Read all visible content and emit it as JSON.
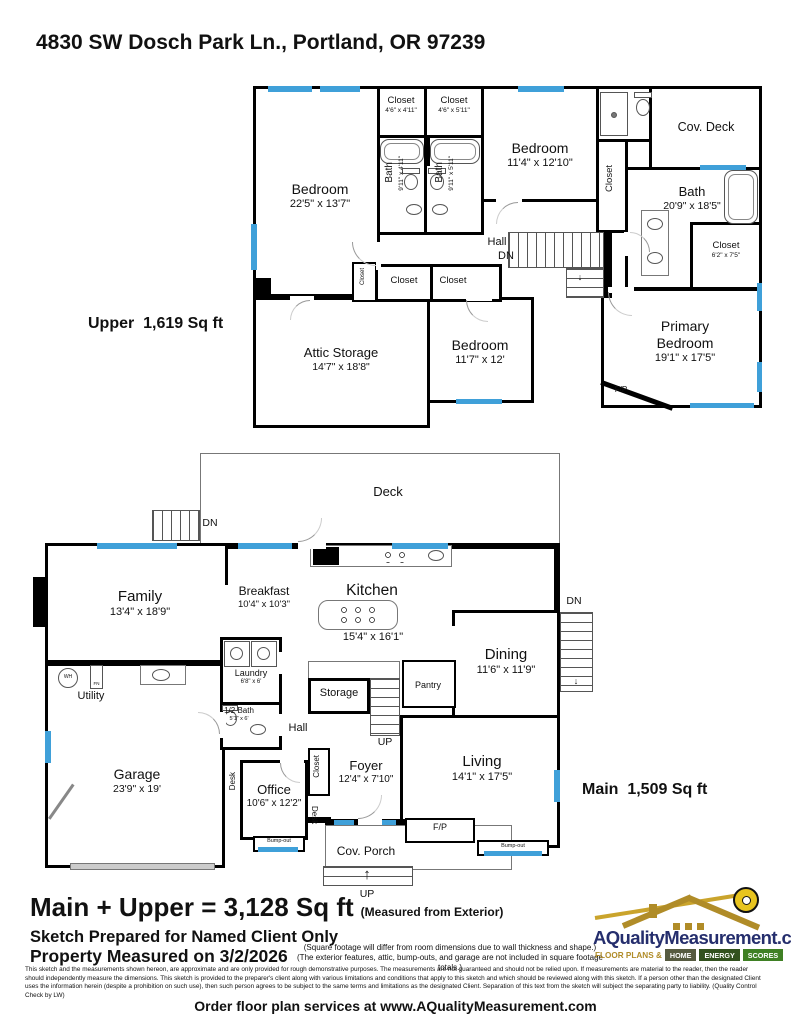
{
  "title": "4830 SW Dosch Park Ln., Portland, OR 97239",
  "icons": {
    "up_arrow": "↑",
    "down_arrow": "↓"
  },
  "upper": {
    "area_label": "Upper  1,619 Sq ft",
    "rooms": {
      "bedroom1": {
        "name": "Bedroom",
        "dims": "22'5\" x 13'7\""
      },
      "closet1": {
        "name": "Closet",
        "dims": "4'6\" x 4'11\""
      },
      "closet2": {
        "name": "Closet",
        "dims": "4'6\" x 5'11\""
      },
      "bath1": {
        "name": "Bath",
        "dims": "9'11\" x 4'11\""
      },
      "bath2": {
        "name": "Bath",
        "dims": "9'11\" x 5'11\""
      },
      "bedroom2": {
        "name": "Bedroom",
        "dims": "11'4\" x 12'10\""
      },
      "cov_deck": {
        "name": "Cov. Deck"
      },
      "closet3": {
        "name": "Closet"
      },
      "bath3": {
        "name": "Bath",
        "dims": "20'9\" x 18'5\""
      },
      "closet4": {
        "name": "Closet",
        "dims": "6'2\" x 7'5\""
      },
      "hall": {
        "name": "Hall"
      },
      "dn": "DN",
      "closet5": {
        "name": "Closet"
      },
      "closet6": {
        "name": "Closet"
      },
      "closet7": {
        "name": "Closet"
      },
      "attic": {
        "name": "Attic Storage",
        "dims": "14'7\" x 18'8\""
      },
      "bedroom3": {
        "name": "Bedroom",
        "dims": "11'7\" x 12'"
      },
      "primary": {
        "name": "Primary Bedroom",
        "dims": "19'1\" x 17'5\""
      },
      "fp": {
        "name": "F/P"
      }
    }
  },
  "main": {
    "area_label": "Main  1,509 Sq ft",
    "rooms": {
      "deck": {
        "name": "Deck"
      },
      "deck_dn": "DN",
      "family": {
        "name": "Family",
        "dims": "13'4\" x 18'9\""
      },
      "breakfast": {
        "name": "Breakfast",
        "dims": "10'4\" x 10'3\""
      },
      "kitchen": {
        "name": "Kitchen",
        "dims": "15'4\" x 16'1\""
      },
      "utility": {
        "name": "Utility"
      },
      "wh": "WH",
      "fn": "FN",
      "laundry": {
        "name": "Laundry",
        "dims": "6'8\" x 6'"
      },
      "half_bath": {
        "name": "1/2 Bath",
        "dims": "5'1\" x 6'"
      },
      "hall": {
        "name": "Hall"
      },
      "storage": {
        "name": "Storage"
      },
      "pantry": {
        "name": "Pantry"
      },
      "up1": "UP",
      "dining": {
        "name": "Dining",
        "dims": "11'6\" x 11'9\""
      },
      "dn_right": "DN",
      "living": {
        "name": "Living",
        "dims": "14'1\" x 17'5\""
      },
      "garage": {
        "name": "Garage",
        "dims": "23'9\" x 19'"
      },
      "office": {
        "name": "Office",
        "dims": "10'6\" x 12'2\""
      },
      "desk1": "Desk",
      "desk2": "Desk",
      "closet_foyer": "Closet",
      "foyer": {
        "name": "Foyer",
        "dims": "12'4\" x 7'10\""
      },
      "cov_porch": {
        "name": "Cov. Porch"
      },
      "up2": "UP",
      "fp": {
        "name": "F/P"
      },
      "bumpout1": "Bump-out",
      "bumpout2": "Bump-out"
    }
  },
  "footer": {
    "total": "Main + Upper = 3,128 Sq ft",
    "total_note": "(Measured from Exterior)",
    "prepared": "Sketch Prepared for Named Client Only",
    "measured_on": "Property Measured on 3/2/2026",
    "note1": "(Square footage will differ from room dimensions due to wall thickness and shape.)",
    "note2": "(The exterior features, attic, bump-outs, and garage are not included in square footage totals.)",
    "disclaimer": "This sketch and the measurements shown hereon, are approximate and are only provided for rough demonstrative purposes.  The measurements are not guaranteed and should not be relied upon.  If measurements are material to the reader, then the reader should independently measure the dimensions.  This sketch is provided to the preparer's client along with various limitations and conditions that apply to this sketch and which should be reviewed along with this sketch.  If a person other than the designated Client uses the information herein (despite a prohibition on such use), then such person agrees to be subject to the same terms and limitations as the designated Client.  Separation of this text from the sketch will subject the separating party to liability.  (Quality Control Check by LW)",
    "order": "Order floor plan services at www.AQualityMeasurement.com"
  },
  "logo": {
    "site": "AQualityMeasurement.com",
    "tagline_left": "FLOOR PLANS &",
    "tagline_segments": [
      "HOME",
      "ENERGY",
      "SCORES"
    ],
    "colors": {
      "navy": "#252e6d",
      "gold": "#b08c28",
      "tape_yellow": "#e8c41f"
    }
  }
}
